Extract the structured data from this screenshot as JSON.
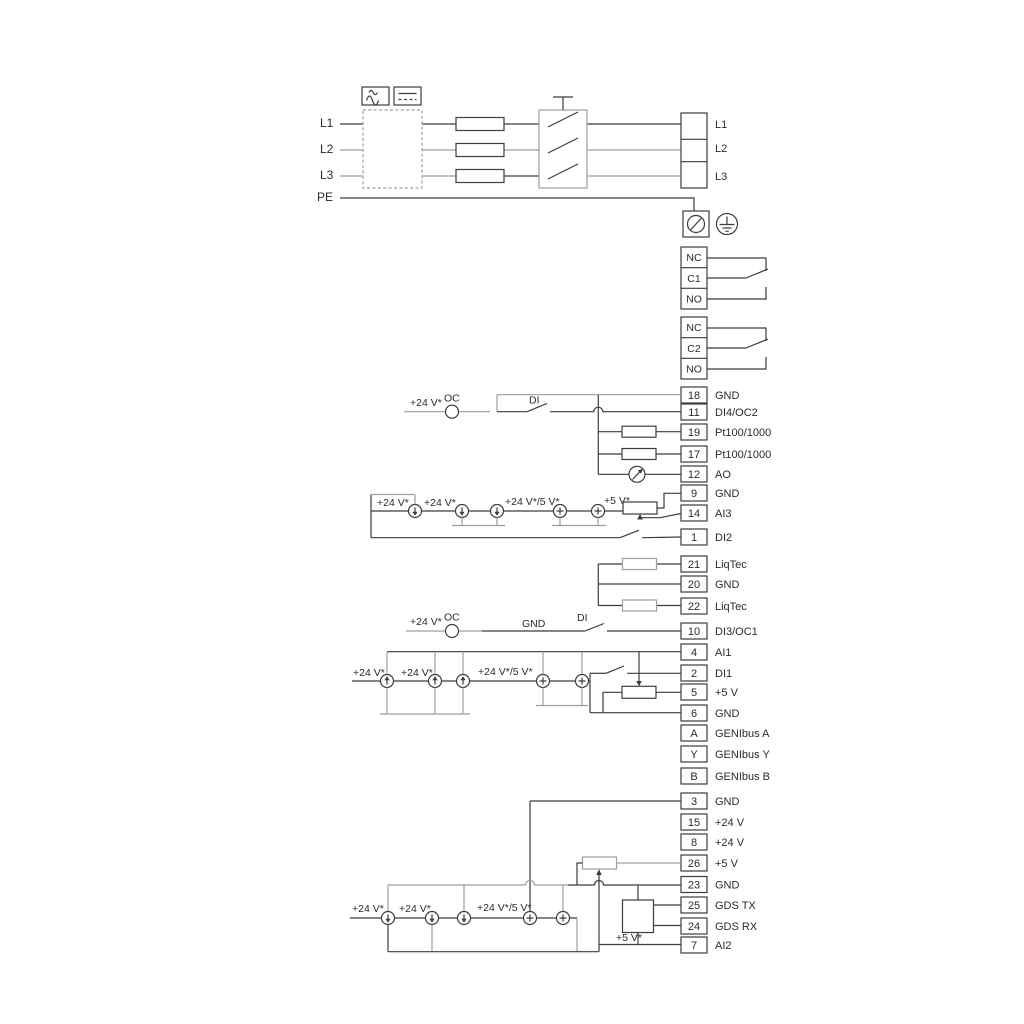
{
  "mains": {
    "in": {
      "l1": "L1",
      "l2": "L2",
      "l3": "L3",
      "pe": "PE"
    },
    "out": {
      "l1": "L1",
      "l2": "L2",
      "l3": "L3"
    }
  },
  "relay1": {
    "nc": "NC",
    "com": "C1",
    "no": "NO"
  },
  "relay2": {
    "nc": "NC",
    "com": "C2",
    "no": "NO"
  },
  "io1": {
    "rows": [
      {
        "n": "18",
        "t": "GND"
      },
      {
        "n": "11",
        "t": "DI4/OC2"
      },
      {
        "n": "19",
        "t": "Pt100/1000"
      },
      {
        "n": "17",
        "t": "Pt100/1000"
      },
      {
        "n": "12",
        "t": "AO"
      },
      {
        "n": "9",
        "t": "GND"
      },
      {
        "n": "14",
        "t": "AI3"
      },
      {
        "n": "1",
        "t": "DI2"
      }
    ]
  },
  "liqtec": {
    "rows": [
      {
        "n": "21",
        "t": "LiqTec"
      },
      {
        "n": "20",
        "t": "GND"
      },
      {
        "n": "22",
        "t": "LiqTec"
      }
    ]
  },
  "io2": {
    "rows": [
      {
        "n": "10",
        "t": "DI3/OC1"
      },
      {
        "n": "4",
        "t": "AI1"
      },
      {
        "n": "2",
        "t": "DI1"
      },
      {
        "n": "5",
        "t": "+5 V"
      },
      {
        "n": "6",
        "t": "GND"
      },
      {
        "n": "A",
        "t": "GENIbus A"
      },
      {
        "n": "Y",
        "t": "GENIbus Y"
      },
      {
        "n": "B",
        "t": "GENIbus B"
      }
    ]
  },
  "io3": {
    "rows": [
      {
        "n": "3",
        "t": "GND"
      },
      {
        "n": "15",
        "t": "+24 V"
      },
      {
        "n": "8",
        "t": "+24 V"
      },
      {
        "n": "26",
        "t": "+5 V"
      },
      {
        "n": "23",
        "t": "GND"
      },
      {
        "n": "25",
        "t": "GDS TX"
      },
      {
        "n": "24",
        "t": "GDS RX"
      },
      {
        "n": "7",
        "t": "AI2"
      }
    ]
  },
  "labels": {
    "v24": "+24 V*",
    "v24_5": "+24 V*/5 V*",
    "v5": "+5 V*",
    "oc": "OC",
    "di": "DI",
    "gnd": "GND"
  },
  "colors": {
    "wire": "#3c3c3c",
    "muted": "#9e9e9e",
    "text": "#2b2b2b",
    "background": "#ffffff"
  }
}
